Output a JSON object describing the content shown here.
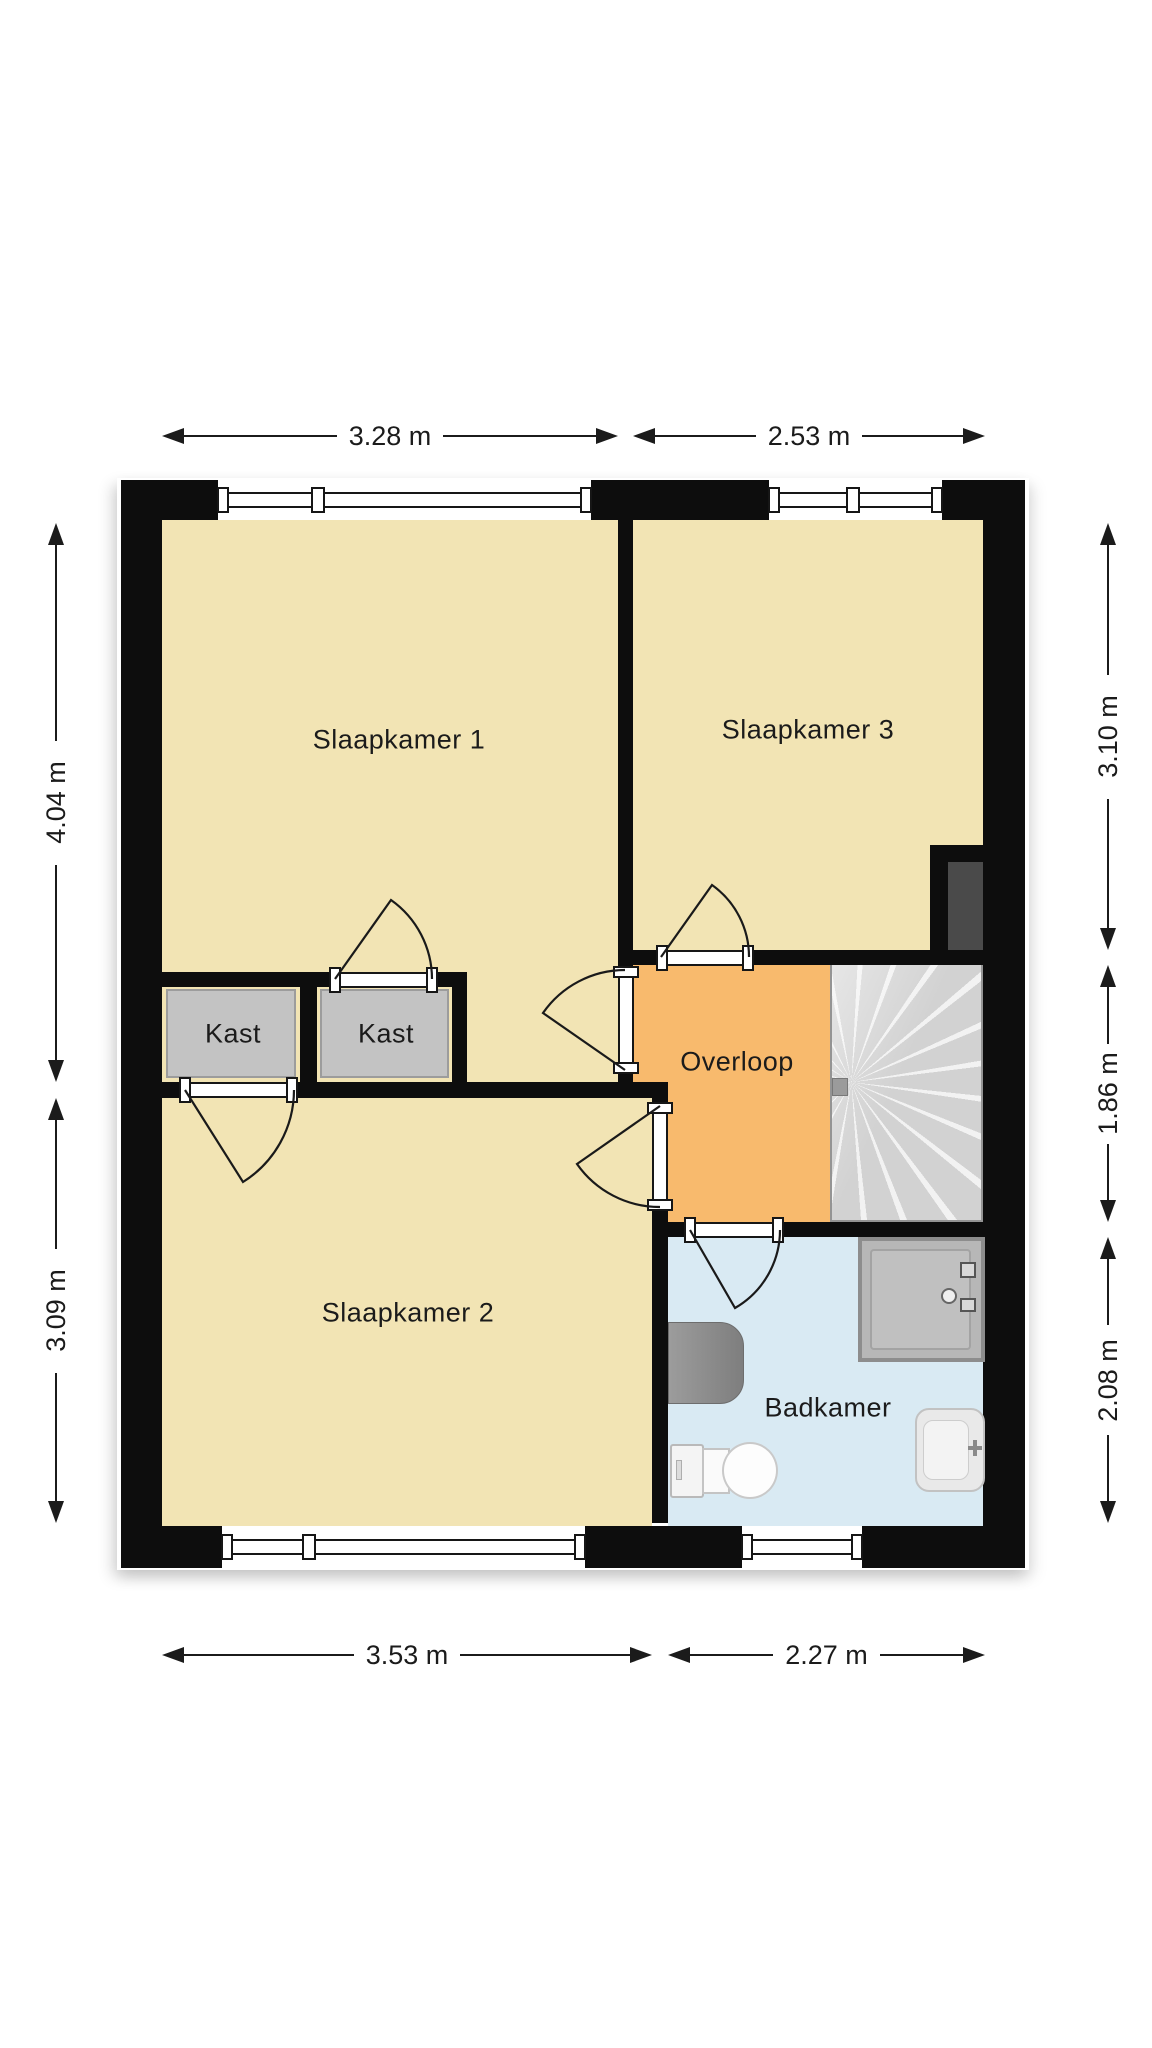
{
  "floorplan": {
    "rooms": [
      {
        "id": "slaapkamer-1",
        "label": "Slaapkamer 1"
      },
      {
        "id": "slaapkamer-3",
        "label": "Slaapkamer 3"
      },
      {
        "id": "kast-1",
        "label": "Kast"
      },
      {
        "id": "kast-2",
        "label": "Kast"
      },
      {
        "id": "overloop",
        "label": "Overloop"
      },
      {
        "id": "slaapkamer-2",
        "label": "Slaapkamer 2"
      },
      {
        "id": "badkamer",
        "label": "Badkamer"
      }
    ],
    "dimensions": {
      "top": [
        "3.28 m",
        "2.53 m"
      ],
      "bottom": [
        "3.53 m",
        "2.27 m"
      ],
      "left": [
        "4.04 m",
        "3.09 m"
      ],
      "right": [
        "3.10 m",
        "1.86 m",
        "2.08 m"
      ]
    },
    "fixtures": [
      "stairs",
      "shower",
      "washing-machine",
      "toilet",
      "sink",
      "duct"
    ],
    "colors": {
      "wall": "#0d0d0d",
      "bedroom": "#f2e4b4",
      "landing": "#f8ba6d",
      "bathroom": "#d9eaf3",
      "closet": "#c3c3c3",
      "stairs": "#d6d6d6",
      "duct": "#4a4a4a",
      "text": "#1b1b1b"
    }
  }
}
